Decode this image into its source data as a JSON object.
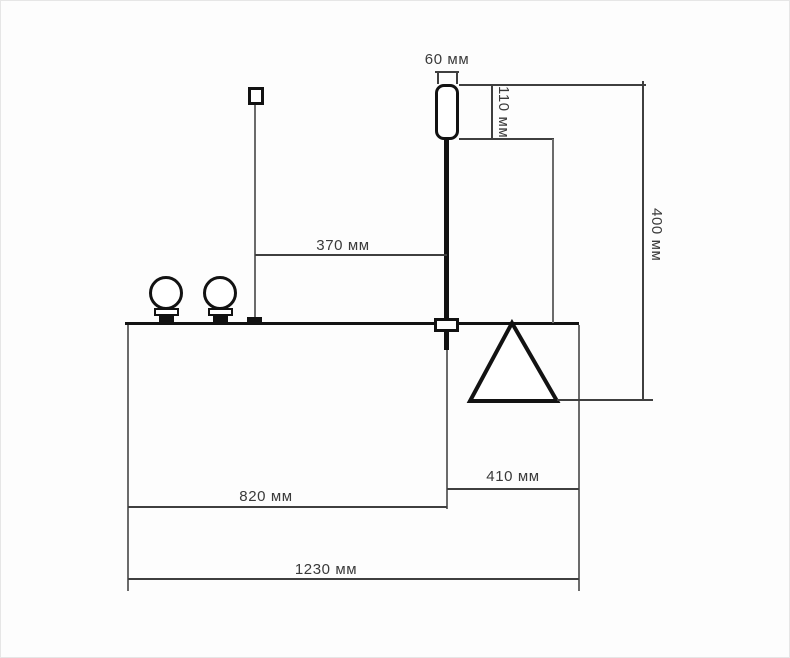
{
  "drawing": {
    "kind": "technical-dimension-diagram",
    "unit": "мм",
    "labels": {
      "d60": "60 мм",
      "d110": "110 мм",
      "d370": "370 мм",
      "d400": "400 мм",
      "d410": "410 мм",
      "d820": "820 мм",
      "d1230": "1230 мм"
    },
    "measurements_mm": {
      "beacon_width": 60,
      "beacon_height": 110,
      "pole_to_left_post": 370,
      "beacon_top_to_triangle_base": 400,
      "pole_to_right_edge": 410,
      "left_edge_to_pole": 820,
      "total_width": 1230
    },
    "colors": {
      "outline": "#121212",
      "dimension_line": "#3f3f3f",
      "text": "#3a3a3a",
      "background": "#fdfdfd"
    }
  }
}
